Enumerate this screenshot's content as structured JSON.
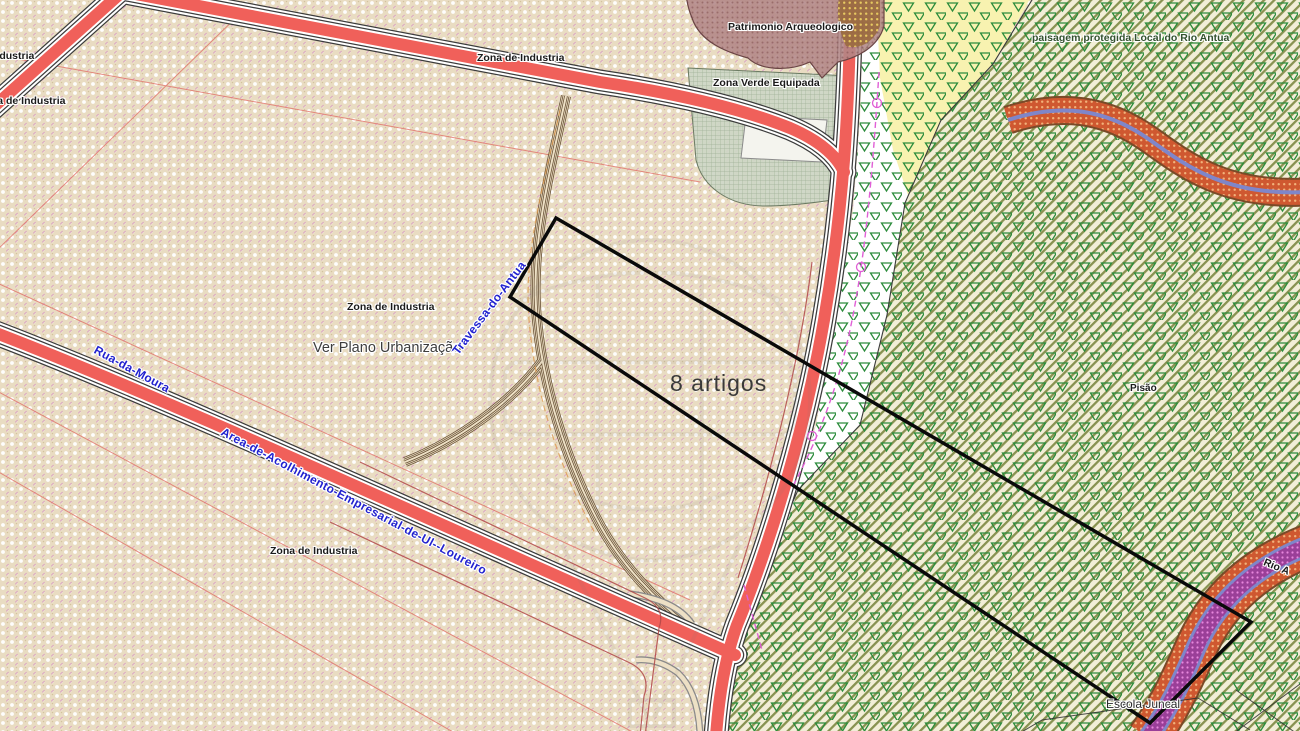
{
  "map": {
    "title": "Planta de ordenamento - zonamento",
    "labels": {
      "industria_topleft": "Industria",
      "zona_topleft": "Zona de Industria",
      "zona_top": "Zona de Industria",
      "patrimonio": "Patrimonio Arqueologico",
      "zona_verde": "Zona Verde Equipada",
      "paisagem": "paisagem protegida Local do Rio Antua",
      "zona_mid": "Zona de Industria",
      "ver_plano": "Ver Plano Urbanização",
      "artigos": "8 artigos",
      "zona_bottom": "Zona de Industria",
      "rua_moura": "Rua-da-Moura",
      "travessa": "Travessa-do-Antua",
      "area_acolhimento": "Area-de-Acolhimento-Empresarial-de-Ul--Loureiro",
      "place_pisao": "Pisão",
      "escola": "Escola Juncal",
      "rio": "Rio A"
    },
    "colors": {
      "road_red": "#f0605a",
      "road_casing": "#3c3c3c",
      "street_label_blue": "#2222cf",
      "industrial_bg": "#e9dcc2",
      "protected_hatch_green": "#6e7a2f",
      "triangle_green": "#2c8c3c",
      "yellow_zone": "#f8f2b0",
      "green_equip_zone": "#cdd6c5",
      "heritage_blob": "#b28686",
      "river_orange": "#cf5830",
      "river_blue": "#7f86c9",
      "river_purple": "#9a3f98",
      "utility_magenta": "#e05fd6",
      "parcel_outline": "#0a0a0a"
    }
  }
}
